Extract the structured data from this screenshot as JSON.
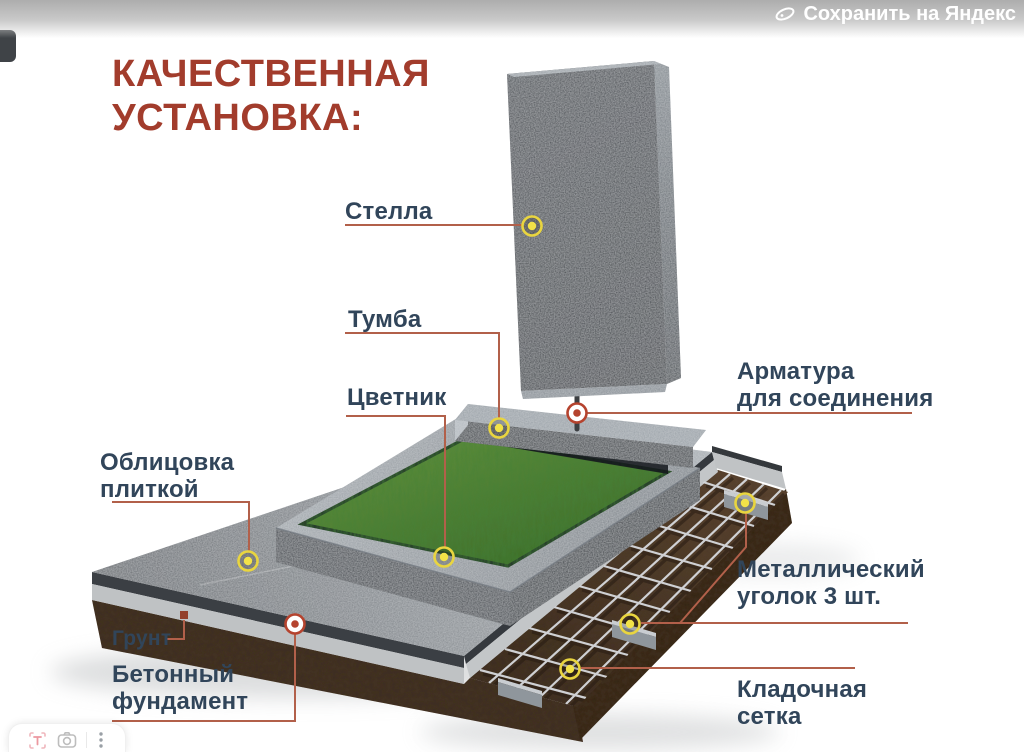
{
  "topbar": {
    "save_label": "Сохранить на Яндекс"
  },
  "title": "КАЧЕСТВЕННАЯ\nУСТАНОВКА:",
  "labels": {
    "stella": "Стелла",
    "tumba": "Тумба",
    "cvetnik": "Цветник",
    "armatura": "Арматура\nдля соединения",
    "oblicovka": "Облицовка\nплиткой",
    "grunt": "Грунт",
    "fundament": "Бетонный\nфундамент",
    "ugolok": "Металлический\nуголок 3 шт.",
    "setka": "Кладочная\nсетка"
  },
  "colors": {
    "title": "#a23c2c",
    "label": "#31455a",
    "connector": "#b2604a",
    "marker_yellow": "#e9d53f",
    "marker_red": "#b5432e"
  },
  "icons": {
    "topbar": "yandex-disk-icon",
    "toolbar": [
      "text-recognition-icon",
      "visual-search-icon",
      "more-menu-icon"
    ]
  }
}
